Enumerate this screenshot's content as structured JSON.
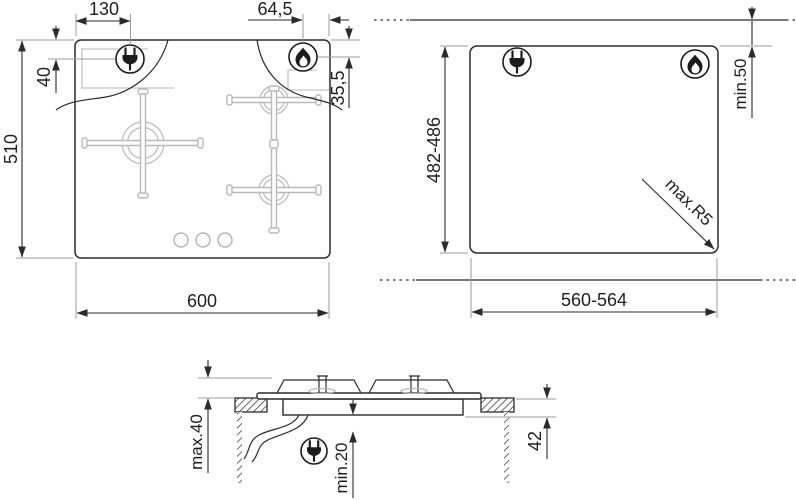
{
  "colors": {
    "ink": "#2b2b2b",
    "extension_gray": "#9b9b9b",
    "burner_gray": "#b9b9b9",
    "background": "#ffffff"
  },
  "views": {
    "hob_top_view": {
      "dims": {
        "left_edge_to_plug": "130",
        "flame_to_right_edge": "64,5",
        "top_edge_to_plug": "40",
        "top_edge_to_flame": "35,5",
        "hob_depth": "510",
        "hob_width": "600"
      },
      "icons": {
        "plug": "power-plug-icon",
        "flame": "gas-flame-icon"
      }
    },
    "cutout_view": {
      "dims": {
        "cutout_depth": "482-486",
        "rear_clearance": "min.50",
        "corner_radius": "max.R5",
        "cutout_width": "560-564"
      },
      "icons": {
        "plug": "power-plug-icon",
        "flame": "gas-flame-icon"
      }
    },
    "section_view": {
      "dims": {
        "height_above_worktop": "max.40",
        "clearance_below": "min.20",
        "recess_depth": "42"
      },
      "icons": {
        "plug": "power-plug-icon"
      }
    }
  }
}
